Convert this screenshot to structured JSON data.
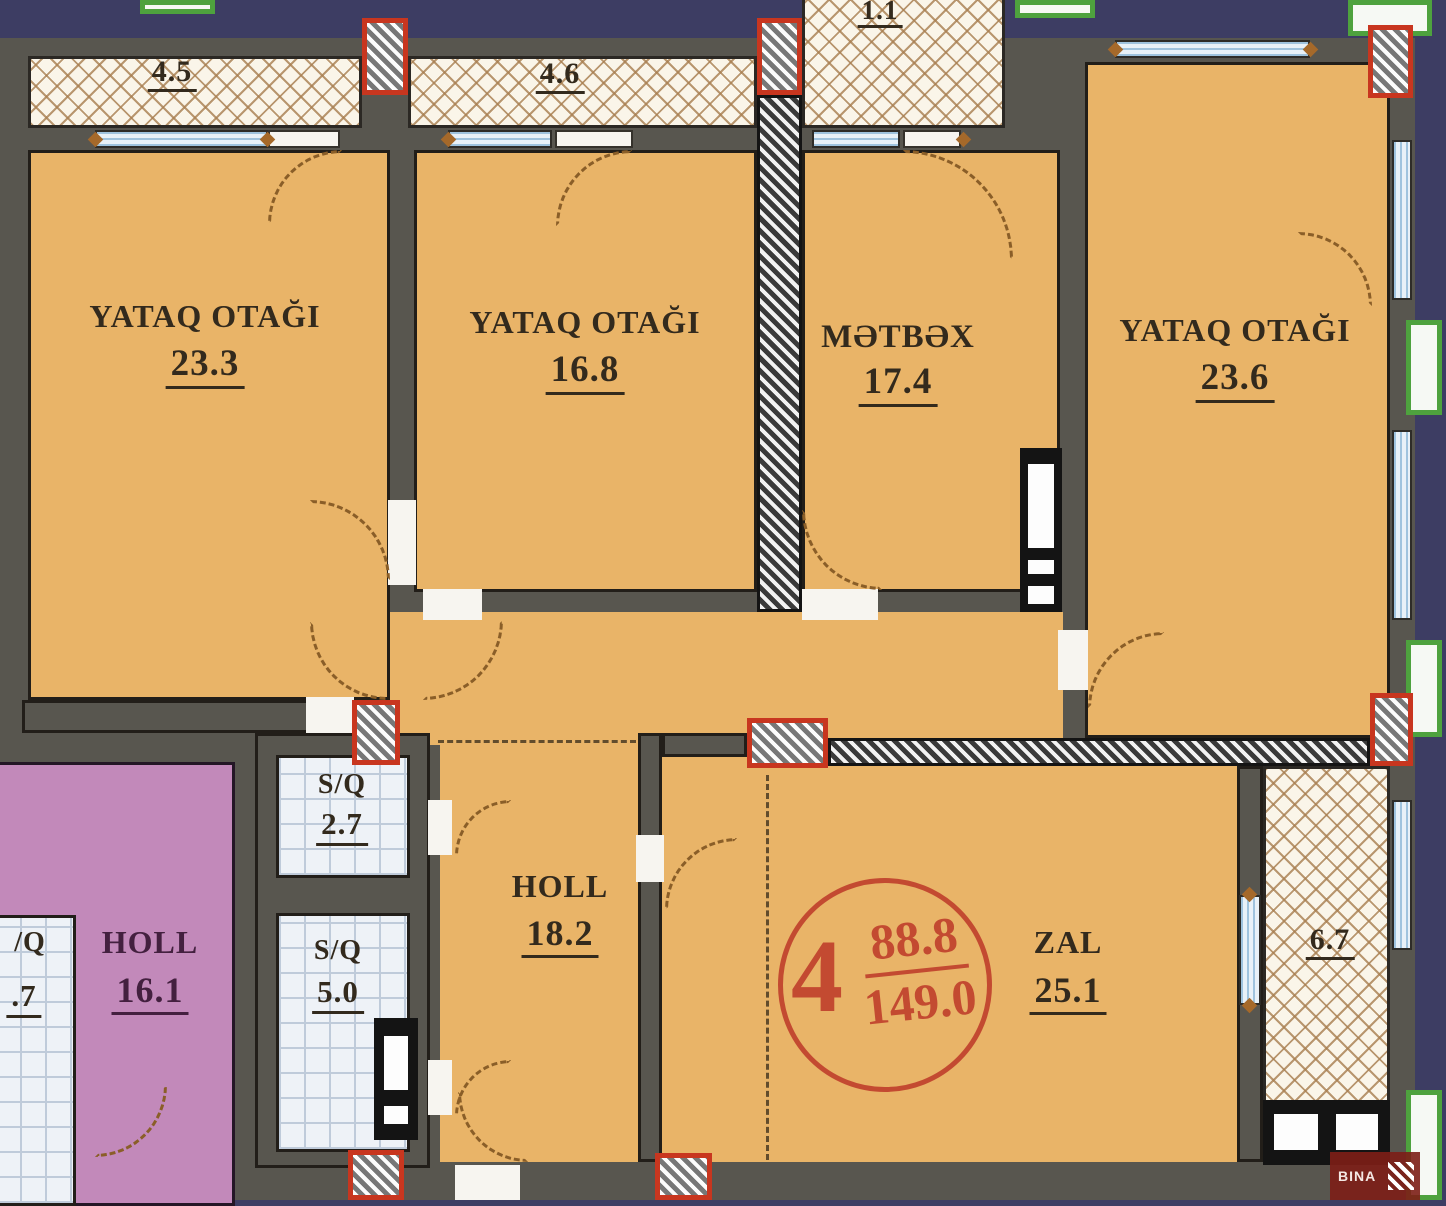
{
  "rooms": [
    {
      "label": "YATAQ OTAĞI",
      "area": "23.3"
    },
    {
      "label": "YATAQ OTAĞI",
      "area": "16.8"
    },
    {
      "label": "MƏTBƏX",
      "area": "17.4"
    },
    {
      "label": "YATAQ OTAĞI",
      "area": "23.6"
    },
    {
      "label": "S/Q",
      "area": "2.7"
    },
    {
      "label": "S/Q",
      "area": "5.0"
    },
    {
      "label": "HOLL",
      "area": "18.2"
    },
    {
      "label": "ZAL",
      "area": "25.1"
    },
    {
      "label": "HOLL",
      "area": "16.1"
    },
    {
      "label": "/Q",
      "area": ".7"
    }
  ],
  "balconies": [
    {
      "area": "4.5"
    },
    {
      "area": "4.6"
    },
    {
      "area": "1.1"
    },
    {
      "area": "6.7"
    }
  ],
  "stamp": {
    "unit": "4",
    "numerator": "88.8",
    "denominator": "149.0"
  },
  "watermark": {
    "text": "BINA"
  }
}
